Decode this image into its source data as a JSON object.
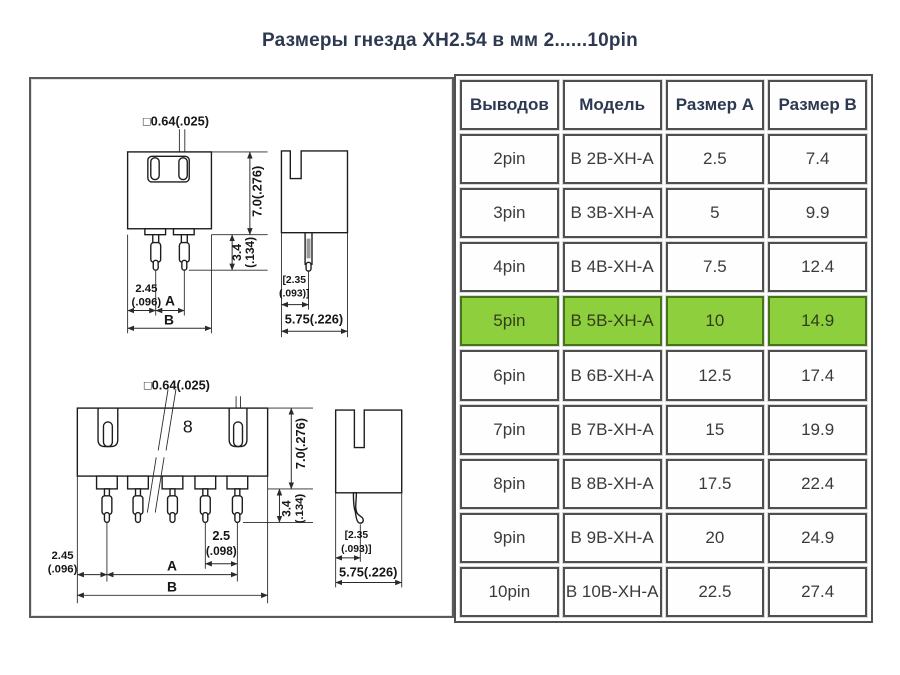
{
  "title": "Размеры гнезда XH2.54 в мм  2......10pin",
  "diagram": {
    "top_front": {
      "pin_size": "□0.64(.025)",
      "height": "7.0(.276)",
      "protrusion_val": "3.4",
      "protrusion_inch": "(.134)",
      "edge_offset_val": "2.45",
      "edge_offset_inch": "(.096)",
      "dim_a": "A",
      "dim_b": "B"
    },
    "top_side": {
      "offset_val": "[2.35",
      "offset_inch": "(.093)]",
      "depth": "5.75(.226)"
    },
    "bottom_front": {
      "pin_size": "□0.64(.025)",
      "count_label": "8",
      "height": "7.0(.276)",
      "protrusion_val": "3.4",
      "protrusion_inch": "(.134)",
      "pitch_val": "2.5",
      "pitch_inch": "(.098)",
      "edge_offset_val": "2.45",
      "edge_offset_inch": "(.096)",
      "dim_a": "A",
      "dim_b": "B"
    },
    "bottom_side": {
      "offset_val": "[2.35",
      "offset_inch": "(.093)]",
      "depth": "5.75(.226)"
    }
  },
  "table": {
    "headers": [
      "Выводов",
      "Модель",
      "Размер A",
      "Размер B"
    ],
    "rows": [
      {
        "pins": "2pin",
        "model": "B 2B-XH-A",
        "size_a": "2.5",
        "size_b": "7.4"
      },
      {
        "pins": "3pin",
        "model": "B 3B-XH-A",
        "size_a": "5",
        "size_b": "9.9"
      },
      {
        "pins": "4pin",
        "model": "B 4B-XH-A",
        "size_a": "7.5",
        "size_b": "12.4"
      },
      {
        "pins": "5pin",
        "model": "B 5B-XH-A",
        "size_a": "10",
        "size_b": "14.9"
      },
      {
        "pins": "6pin",
        "model": "B 6B-XH-A",
        "size_a": "12.5",
        "size_b": "17.4"
      },
      {
        "pins": "7pin",
        "model": "B 7B-XH-A",
        "size_a": "15",
        "size_b": "19.9"
      },
      {
        "pins": "8pin",
        "model": "B 8B-XH-A",
        "size_a": "17.5",
        "size_b": "22.4"
      },
      {
        "pins": "9pin",
        "model": "B 9B-XH-A",
        "size_a": "20",
        "size_b": "24.9"
      },
      {
        "pins": "10pin",
        "model": "B 10B-XH-A",
        "size_a": "22.5",
        "size_b": "27.4"
      }
    ],
    "highlight_row_index": 3,
    "highlight_color": "#8ecf3e"
  }
}
